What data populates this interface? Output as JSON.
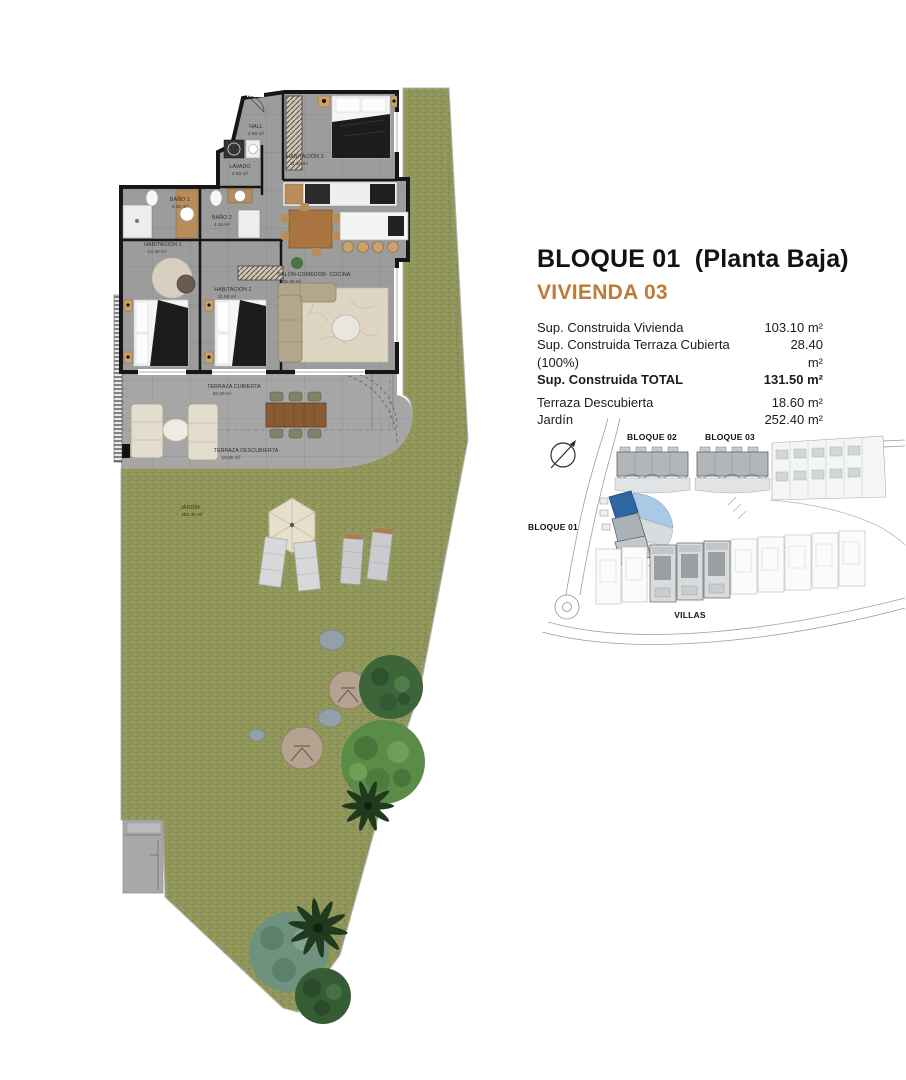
{
  "header": {
    "title": "BLOQUE 01  (Planta Baja)",
    "subtitle": "VIVIENDA 03"
  },
  "areas_table": {
    "rows": [
      {
        "label": "Sup. Construida Vivienda",
        "value": "103.10 m²",
        "bold": false
      },
      {
        "label": "Sup. Construida Terraza Cubierta (100%)",
        "value": "28.40 m²",
        "bold": false
      },
      {
        "label": "Sup. Construida TOTAL",
        "value": "131.50 m²",
        "bold": true
      },
      {
        "label": "Terraza Descubierta",
        "value": "18.60 m²",
        "bold": false
      },
      {
        "label": "Jardín",
        "value": "252.40 m²",
        "bold": false
      }
    ]
  },
  "floorplan": {
    "rooms": [
      {
        "id": "hall",
        "label": "HALL",
        "area": "2.60 m²"
      },
      {
        "id": "lavado",
        "label": "LAVADO",
        "area": "2.50 m²"
      },
      {
        "id": "habitacion-3",
        "label": "HABITACIÓN 3",
        "area": "11.10 m²"
      },
      {
        "id": "bano-1",
        "label": "BAÑO 1",
        "area": "4.60 m²"
      },
      {
        "id": "bano-2",
        "label": "BAÑO 2",
        "area": "4.15 m²"
      },
      {
        "id": "habitacion-1",
        "label": "HABITACIÓN 1",
        "area": "13.40 m²"
      },
      {
        "id": "habitacion-2",
        "label": "HABITACIÓN 2",
        "area": "11.50 m²"
      },
      {
        "id": "salon-comedor-cocina",
        "label": "SALÓN-COMEDOR- COCINA",
        "area": "35.40 m²"
      },
      {
        "id": "terraza-cubierta",
        "label": "TERRAZA CUBIERTA",
        "area": "28.40 m²"
      },
      {
        "id": "terraza-descubierta",
        "label": "TERRAZA DESCUBIERTA",
        "area": "18.60 m²"
      },
      {
        "id": "jardin",
        "label": "JARDÍN",
        "area": "252.40 m²"
      }
    ]
  },
  "siteplan": {
    "labels": {
      "bloque01": "BLOQUE 01",
      "bloque02": "BLOQUE 02",
      "bloque03": "BLOQUE 03",
      "villas": "VILLAS"
    }
  },
  "colors": {
    "accent_orange": "#BE7B34",
    "highlight_blue": "#2F66A3",
    "highlight_light_blue": "#AAC9E6",
    "garden_green": "#91975A"
  }
}
